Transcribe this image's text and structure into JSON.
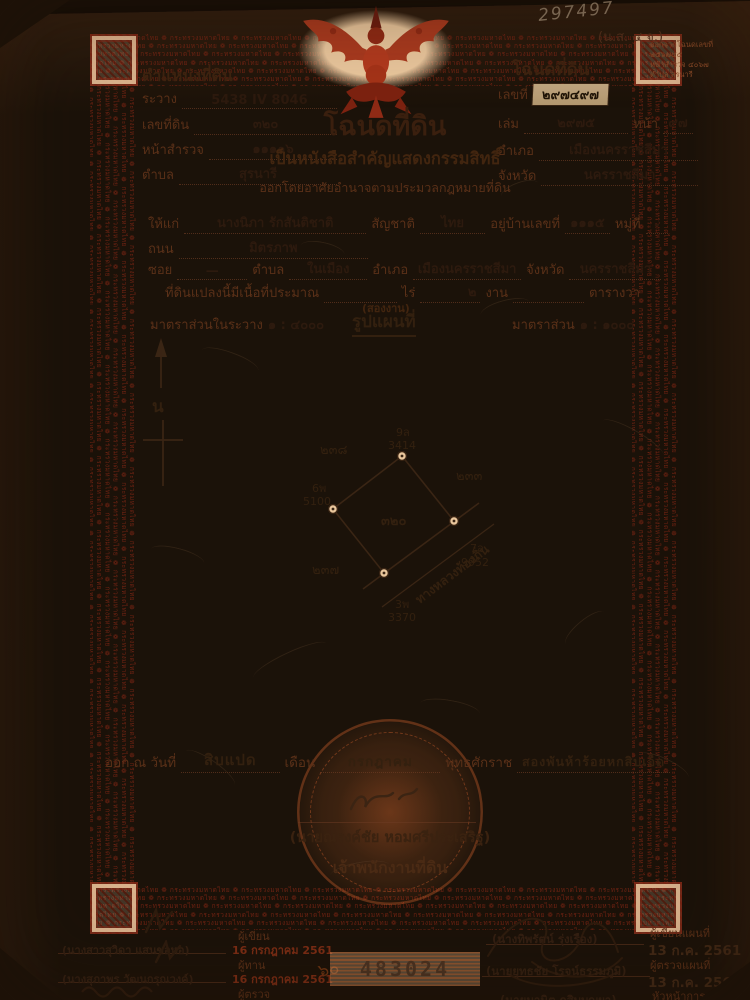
{
  "meta": {
    "pencil_number": "297497",
    "form_code": "(น.ส. ๔ จ.)",
    "corner_note_line1": "ออกจากโฉนดเลขที่",
    "corner_note_line2": "๒๕๖๗๔๕",
    "corner_note_line3": "หน้าสำรวจ ๔๐๖๗",
    "corner_note_line4": "ตำบล สุรนารี"
  },
  "border": {
    "pattern": "❁ กระทรวงมหาดไทย "
  },
  "position": {
    "title": "ตำแหน่งที่ดิน",
    "survey_label": "ระวาง",
    "survey": "5438 IV 8046",
    "parcel_label": "เลขที่ดิน",
    "parcel": "๓๒๐",
    "page_label": "หน้าสำรวจ",
    "page": "๑๑๑๑๖",
    "tambon_label": "ตำบล",
    "tambon": "สุรนารี"
  },
  "deed": {
    "title": "โฉนดที่ดิน",
    "no_label": "เลขที่",
    "no": "๒๙๗๔๙๗",
    "book_label": "เล่ม",
    "book": "๒๙๗๕",
    "page_label": "หน้า",
    "page": "๙๗",
    "amphoe_label": "อำเภอ",
    "amphoe": "เมืองนครราชสีมา",
    "province_label": "จังหวัด",
    "province": "นครราชสีมา"
  },
  "heading": {
    "title": "โฉนดที่ดิน",
    "line1": "เป็นหนังสือสำคัญแสดงกรรมสิทธิ์",
    "line2": "ออกโดยอาศัยอำนาจตามประมวลกฎหมายที่ดิน"
  },
  "grantee": {
    "to_label": "ให้แก่",
    "name": "นางนิภา รักสันติชาติ",
    "nationality_label": "สัญชาติ",
    "nationality": "ไทย",
    "address_label": "อยู่บ้านเลขที่",
    "address": "๑๑๑๕",
    "moo_label": "หมู่ที่",
    "moo": "-",
    "road_label": "ถนน",
    "road": "มิตรภาพ",
    "soi_label": "ซอย",
    "soi": "—",
    "tambon_label": "ตำบล",
    "tambon": "ในเมือง",
    "amphoe_label": "อำเภอ",
    "amphoe": "เมืองนครราชสีมา",
    "province_label": "จังหวัด",
    "province": "นครราชสีมา"
  },
  "area": {
    "prefix": "ที่ดินแปลงนี้มีเนื้อที่ประมาณ",
    "rai_label": "ไร่",
    "ngan_value": "๒",
    "ngan_label": "งาน",
    "wa_label": "ตารางวา",
    "note": "(สองงาน)"
  },
  "map": {
    "scale_in_label": "มาตราส่วนในระวาง",
    "scale_in": "๑ : ๔๐๐๐",
    "title": "รูปแผนที่",
    "scale_label": "มาตราส่วน",
    "scale": "๑ : ๑๐๐๐",
    "north": "น",
    "parcel": "๓๒๐",
    "neighbor_top_left": "๒๓๘",
    "neighbor_right": "๒๓๓",
    "neighbor_bottom_left": "๒๓๗",
    "corner_top_id": "9ล",
    "corner_top_len": "3414",
    "corner_left_id": "6พ",
    "corner_left_len": "5100",
    "corner_right_id": "7ล",
    "corner_right_len": "9952",
    "corner_bottom_id": "3พ",
    "corner_bottom_len": "3370",
    "road": "ทางหลวงท้องถิ่น"
  },
  "issue": {
    "prefix": "ออก ณ วันที่",
    "day": "สิบแปด",
    "month_label": "เดือน",
    "month": "กรกฎาคม",
    "era_label": "พุทธศักราช",
    "year": "สองพันห้าร้อยหกสิบเอ็ด"
  },
  "officer": {
    "name": "(นายณรงค์ชัย หอมศรีประเสริฐ)",
    "title": "เจ้าพนักงานที่ดิน"
  },
  "serial": "483024",
  "left_signoff": {
    "annotation": "๖๐",
    "rows": [
      {
        "name": "(นางสาวสุวิดา แสนขอหอ)",
        "role": "ผู้เขียน",
        "date": "16 กรกฎาคม 2561"
      },
      {
        "name": "(นางสุภาพร วัฒนกรุณวงค์)",
        "role": "ผู้ทาน",
        "date": "16 กรกฎาคม 2561"
      },
      {
        "name": "(นาย…)",
        "role": "ผู้ตรวจ",
        "date": ""
      }
    ]
  },
  "right_signoff": {
    "rows": [
      {
        "name": "(นางทิพรัตน์ รุ่งเรือง)",
        "role": "ผู้เขียนแผนที่",
        "date": "13 ก.ค. 2561"
      },
      {
        "name": "(นายยุทธชัย โรจน์ธรรมภูมิ)",
        "role": "ผู้ตรวจแผนที่",
        "date": "13 ก.ค. 2561"
      },
      {
        "name": "(นายมานิต กสิบบุญผา)",
        "role": "หัวหน้าการ",
        "date": "13 ก.ค. 2561"
      }
    ]
  }
}
